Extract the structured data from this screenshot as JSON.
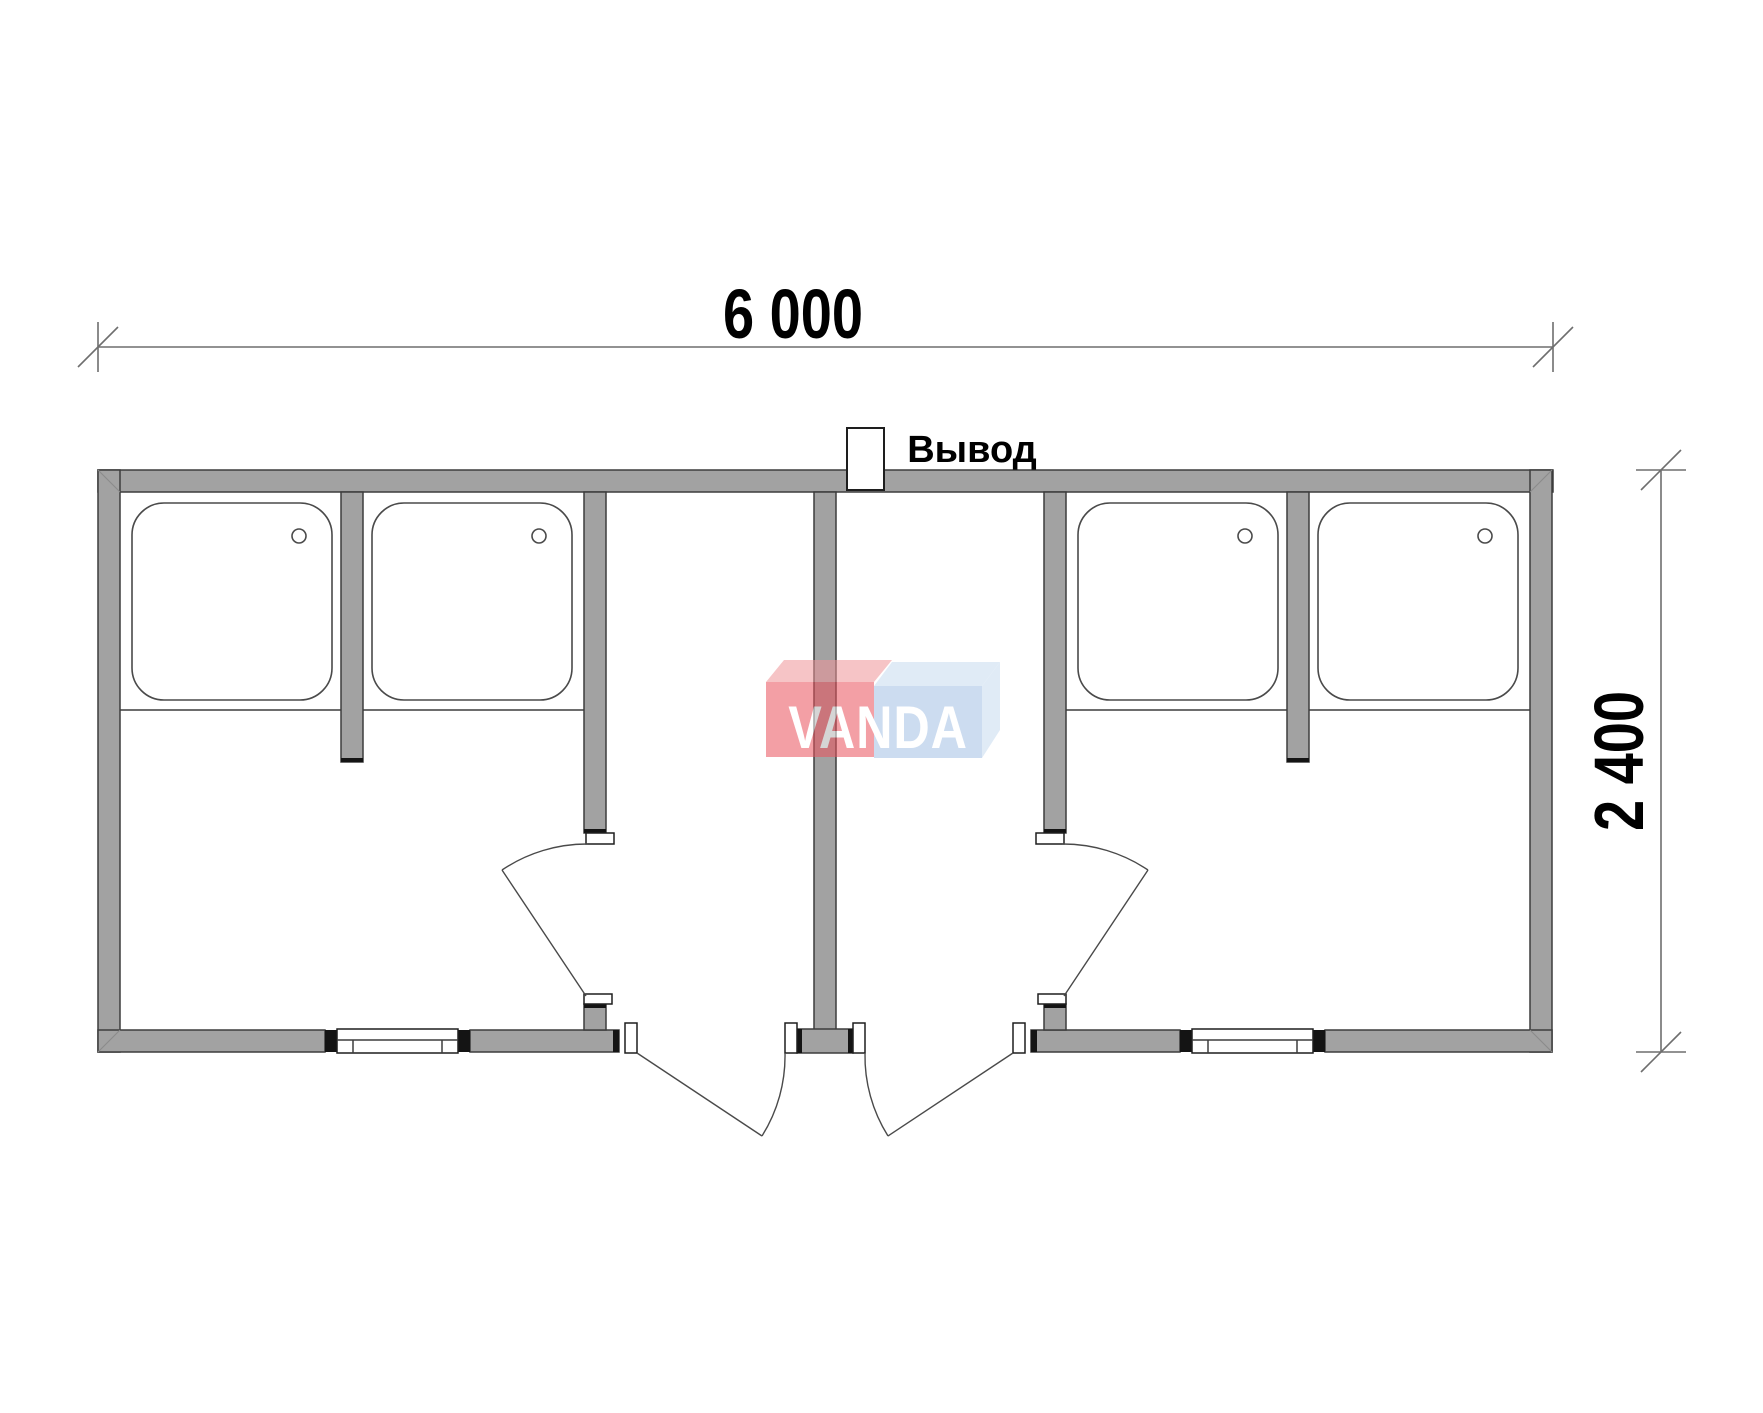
{
  "page": {
    "background": "#ffffff"
  },
  "plan": {
    "wall_fill": "#a2a2a2",
    "line_color": "#3d3d3d",
    "outlet_label": "Вывод",
    "shower_tray_count_visible": 4
  },
  "dimensions": {
    "width_label": "6 000",
    "height_label": "2 400",
    "line_color": "#6e6e6e"
  },
  "watermark": {
    "text": "VANDA",
    "opacity": 0.55,
    "red_front": "#eb525d",
    "red_top": "#ef9499",
    "blue_front": "#a4c1e4",
    "blue_top": "#c7dbf0",
    "letter_color": "#ffffff"
  }
}
